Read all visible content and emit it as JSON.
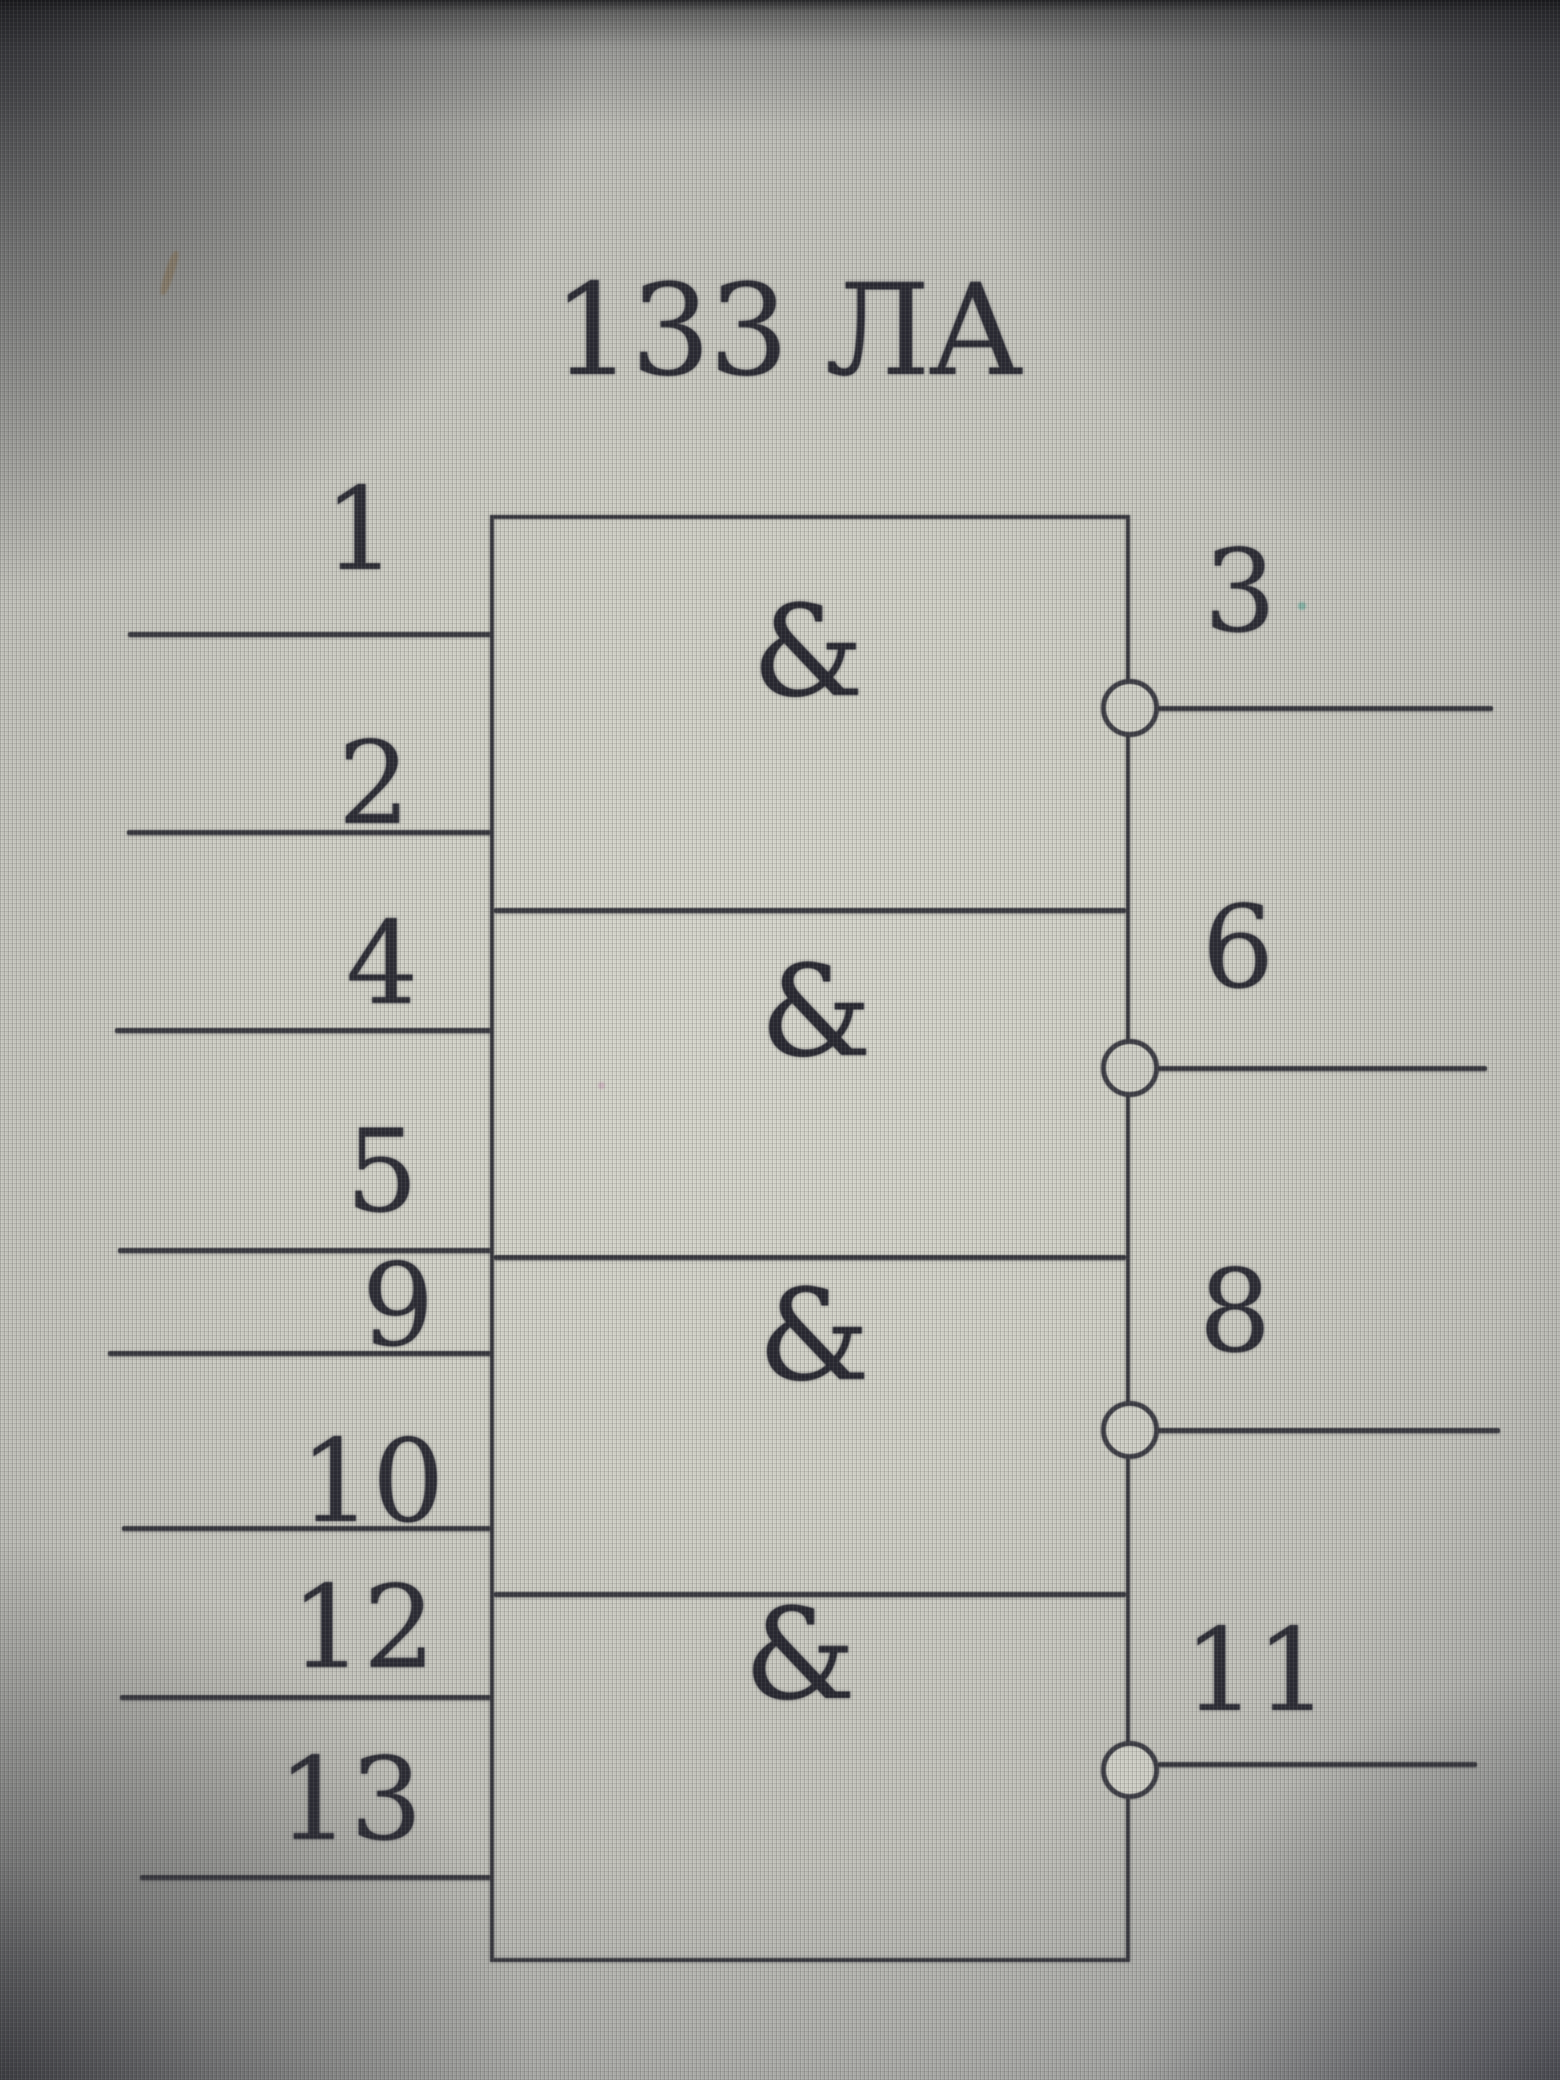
{
  "title": "133 ЛА",
  "gates": [
    {
      "function": "&",
      "input_pins": [
        "1",
        "2"
      ],
      "output_pin": "3"
    },
    {
      "function": "&",
      "input_pins": [
        "4",
        "5"
      ],
      "output_pin": "6"
    },
    {
      "function": "&",
      "input_pins": [
        "9",
        "10"
      ],
      "output_pin": "8"
    },
    {
      "function": "&",
      "input_pins": [
        "12",
        "13"
      ],
      "output_pin": "11"
    }
  ],
  "colors": {
    "ink": "#2e2e36",
    "screen_center": "#d9d9cf",
    "screen_edge": "#64656d"
  }
}
